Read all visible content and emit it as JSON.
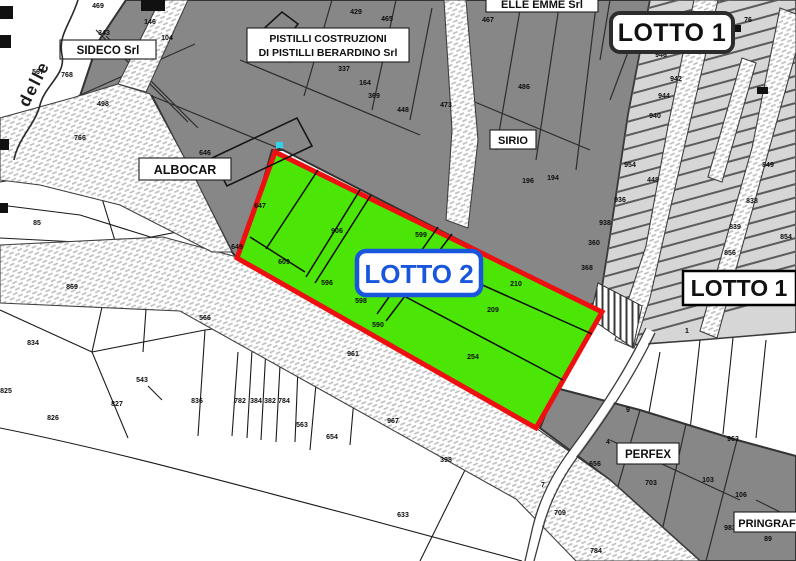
{
  "lots": {
    "lotto1_top": "LOTTO 1",
    "lotto1_right": "LOTTO 1",
    "lotto2": "LOTTO 2"
  },
  "companies": {
    "sideco": "SIDECO Srl",
    "pistilli_line1": "PISTILLI COSTRUZIONI",
    "pistilli_line2": "DI PISTILLI BERARDINO Srl",
    "albocar": "ALBOCAR",
    "sirio": "SIRIO",
    "elle_emme": "ELLE EMME Srl",
    "perfex": "PERFEX",
    "pringraf": "PRINGRAF"
  },
  "street": {
    "name": "delle"
  },
  "colors": {
    "lot2_fill": "#4BE606",
    "lot2_border": "#EE1010",
    "lot2_label": "#1956DE",
    "zone_dark": "#878787",
    "zone_light": "#D6D6D6"
  },
  "parcels": [
    {
      "x": 98,
      "y": 8,
      "t": "469"
    },
    {
      "x": 150,
      "y": 24,
      "t": "146"
    },
    {
      "x": 104,
      "y": 35,
      "t": "343"
    },
    {
      "x": 167,
      "y": 40,
      "t": "104"
    },
    {
      "x": 38,
      "y": 74,
      "t": "567"
    },
    {
      "x": 67,
      "y": 77,
      "t": "768"
    },
    {
      "x": 103,
      "y": 106,
      "t": "498"
    },
    {
      "x": 80,
      "y": 140,
      "t": "766"
    },
    {
      "x": 205,
      "y": 155,
      "t": "646"
    },
    {
      "x": 356,
      "y": 14,
      "t": "429"
    },
    {
      "x": 387,
      "y": 21,
      "t": "465"
    },
    {
      "x": 344,
      "y": 71,
      "t": "337"
    },
    {
      "x": 365,
      "y": 85,
      "t": "164"
    },
    {
      "x": 374,
      "y": 98,
      "t": "369"
    },
    {
      "x": 403,
      "y": 112,
      "t": "448"
    },
    {
      "x": 446,
      "y": 107,
      "t": "473"
    },
    {
      "x": 488,
      "y": 22,
      "t": "467"
    },
    {
      "x": 524,
      "y": 89,
      "t": "486"
    },
    {
      "x": 553,
      "y": 180,
      "t": "194"
    },
    {
      "x": 528,
      "y": 183,
      "t": "196"
    },
    {
      "x": 625,
      "y": 16,
      "t": "77"
    },
    {
      "x": 748,
      "y": 22,
      "t": "76"
    },
    {
      "x": 661,
      "y": 57,
      "t": "946"
    },
    {
      "x": 676,
      "y": 81,
      "t": "942"
    },
    {
      "x": 664,
      "y": 98,
      "t": "944"
    },
    {
      "x": 655,
      "y": 118,
      "t": "940"
    },
    {
      "x": 630,
      "y": 167,
      "t": "954"
    },
    {
      "x": 653,
      "y": 182,
      "t": "448"
    },
    {
      "x": 620,
      "y": 202,
      "t": "936"
    },
    {
      "x": 605,
      "y": 225,
      "t": "938"
    },
    {
      "x": 594,
      "y": 245,
      "t": "360"
    },
    {
      "x": 587,
      "y": 270,
      "t": "368"
    },
    {
      "x": 768,
      "y": 167,
      "t": "849"
    },
    {
      "x": 752,
      "y": 203,
      "t": "838"
    },
    {
      "x": 735,
      "y": 229,
      "t": "839"
    },
    {
      "x": 786,
      "y": 239,
      "t": "854"
    },
    {
      "x": 730,
      "y": 255,
      "t": "856"
    },
    {
      "x": 687,
      "y": 333,
      "t": "1"
    },
    {
      "x": 260,
      "y": 208,
      "t": "647"
    },
    {
      "x": 237,
      "y": 249,
      "t": "649"
    },
    {
      "x": 337,
      "y": 233,
      "t": "906"
    },
    {
      "x": 421,
      "y": 237,
      "t": "599"
    },
    {
      "x": 284,
      "y": 264,
      "t": "609"
    },
    {
      "x": 327,
      "y": 285,
      "t": "596"
    },
    {
      "x": 361,
      "y": 303,
      "t": "598"
    },
    {
      "x": 378,
      "y": 327,
      "t": "590"
    },
    {
      "x": 516,
      "y": 286,
      "t": "210"
    },
    {
      "x": 493,
      "y": 312,
      "t": "209"
    },
    {
      "x": 473,
      "y": 359,
      "t": "254"
    },
    {
      "x": 37,
      "y": 225,
      "t": "85"
    },
    {
      "x": 72,
      "y": 289,
      "t": "869"
    },
    {
      "x": 33,
      "y": 345,
      "t": "834"
    },
    {
      "x": 205,
      "y": 320,
      "t": "566"
    },
    {
      "x": 142,
      "y": 382,
      "t": "543"
    },
    {
      "x": 117,
      "y": 406,
      "t": "827"
    },
    {
      "x": 53,
      "y": 420,
      "t": "826"
    },
    {
      "x": 6,
      "y": 393,
      "t": "825"
    },
    {
      "x": 197,
      "y": 403,
      "t": "836"
    },
    {
      "x": 240,
      "y": 403,
      "t": "782"
    },
    {
      "x": 256,
      "y": 403,
      "t": "384"
    },
    {
      "x": 270,
      "y": 403,
      "t": "382"
    },
    {
      "x": 284,
      "y": 403,
      "t": "784"
    },
    {
      "x": 302,
      "y": 427,
      "t": "563"
    },
    {
      "x": 332,
      "y": 439,
      "t": "654"
    },
    {
      "x": 393,
      "y": 423,
      "t": "967"
    },
    {
      "x": 446,
      "y": 462,
      "t": "398"
    },
    {
      "x": 403,
      "y": 517,
      "t": "633"
    },
    {
      "x": 353,
      "y": 356,
      "t": "961"
    },
    {
      "x": 628,
      "y": 412,
      "t": "9"
    },
    {
      "x": 608,
      "y": 444,
      "t": "4"
    },
    {
      "x": 651,
      "y": 485,
      "t": "703"
    },
    {
      "x": 708,
      "y": 482,
      "t": "103"
    },
    {
      "x": 741,
      "y": 497,
      "t": "106"
    },
    {
      "x": 595,
      "y": 466,
      "t": "656"
    },
    {
      "x": 543,
      "y": 487,
      "t": "7"
    },
    {
      "x": 560,
      "y": 515,
      "t": "709"
    },
    {
      "x": 596,
      "y": 553,
      "t": "784"
    },
    {
      "x": 733,
      "y": 441,
      "t": "963"
    },
    {
      "x": 730,
      "y": 530,
      "t": "983"
    },
    {
      "x": 768,
      "y": 541,
      "t": "89"
    }
  ]
}
